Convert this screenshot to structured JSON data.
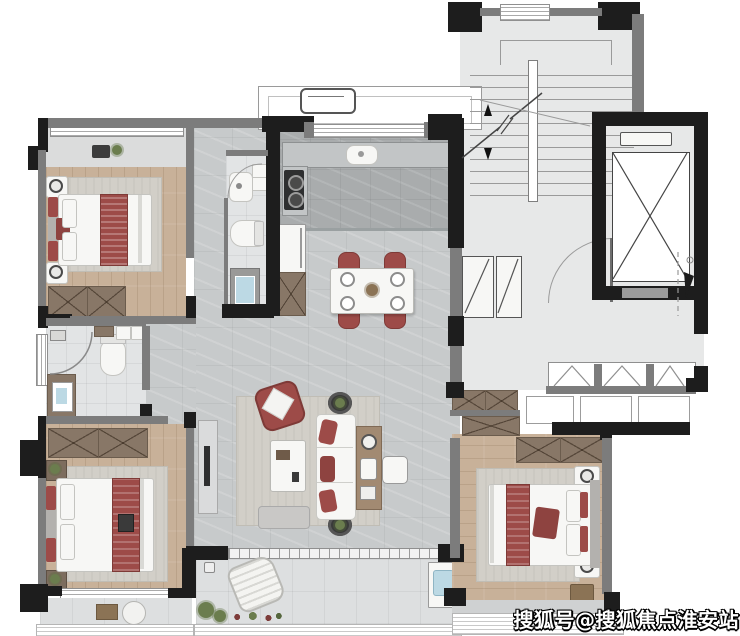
{
  "watermark": {
    "text": "搜狐号@搜狐焦点淮安站"
  },
  "colors": {
    "wall": "#1d1d1d",
    "wall-gray": "#7c7c7c",
    "floor-stair": "#e7e8e8",
    "floor-marble": "#c7cacb",
    "floor-marble-dark": "#a9acad",
    "floor-tile": "#e2e4e5",
    "floor-wood": "#c8b199",
    "floor-balcony": "#dddfe0",
    "cabinet-brown": "#887767",
    "accent-red": "#9d4b48",
    "accent-red-dark": "#8e4340",
    "rug": "#d2cfc8",
    "furniture-white": "#f7f7f5",
    "console-wood": "#a28a72",
    "water-blue": "#bcd9e4",
    "plant-green": "#6b7d4e",
    "tv-dark": "#2e2f30"
  },
  "floorplan": {
    "type": "residential-apartment-floor-plan",
    "rooms": [
      {
        "name": "bedroom-top-left",
        "furniture": [
          "double-bed-with-red-runner",
          "two-nightstands-with-lamps",
          "rug",
          "wardrobe",
          "bay-window-with-plants"
        ]
      },
      {
        "name": "bathroom-inner",
        "furniture": [
          "vanity-sink",
          "washer",
          "toilet",
          "shower"
        ]
      },
      {
        "name": "kitchen",
        "furniture": [
          "counter-sink",
          "two-burner-stove",
          "fridge",
          "pantry-cabinet",
          "window"
        ]
      },
      {
        "name": "dining-area",
        "furniture": [
          "dining-table",
          "four-red-chairs",
          "place-settings"
        ]
      },
      {
        "name": "living-room",
        "furniture": [
          "tv-console",
          "tv",
          "rug",
          "red-armchair",
          "coffee-table",
          "white-sofa-red-cushions",
          "console-table",
          "two-side-tables",
          "bench",
          "stool"
        ]
      },
      {
        "name": "foyer",
        "furniture": [
          "two-shoe-cabinets",
          "entry-door"
        ]
      },
      {
        "name": "stairwell",
        "furniture": [
          "stairs-with-direction-arrow",
          "window"
        ]
      },
      {
        "name": "elevator",
        "furniture": [
          "elevator-cab-x-symbol",
          "call-panel"
        ]
      },
      {
        "name": "corridor",
        "furniture": [
          "casement-windows",
          "planter-boxes"
        ]
      },
      {
        "name": "bathroom-bottom-left",
        "furniture": [
          "corner-shower",
          "toilet",
          "vanity-sink",
          "washer"
        ]
      },
      {
        "name": "bedroom-bottom-left",
        "furniture": [
          "double-bed-with-red-runner",
          "two-nightstands-with-plants",
          "rug",
          "wardrobe"
        ]
      },
      {
        "name": "bedroom-bottom-right",
        "furniture": [
          "double-bed-with-red-runner",
          "two-nightstands-with-lamps",
          "rug",
          "wardrobe",
          "stool"
        ]
      },
      {
        "name": "balcony-main",
        "furniture": [
          "lounge-chair",
          "plants",
          "wash-basin",
          "floor-drains",
          "railing"
        ]
      },
      {
        "name": "balcony-left",
        "furniture": [
          "tray",
          "basin",
          "railing"
        ]
      },
      {
        "name": "ac-platform",
        "furniture": [
          "ac-outdoor-unit"
        ]
      }
    ]
  }
}
